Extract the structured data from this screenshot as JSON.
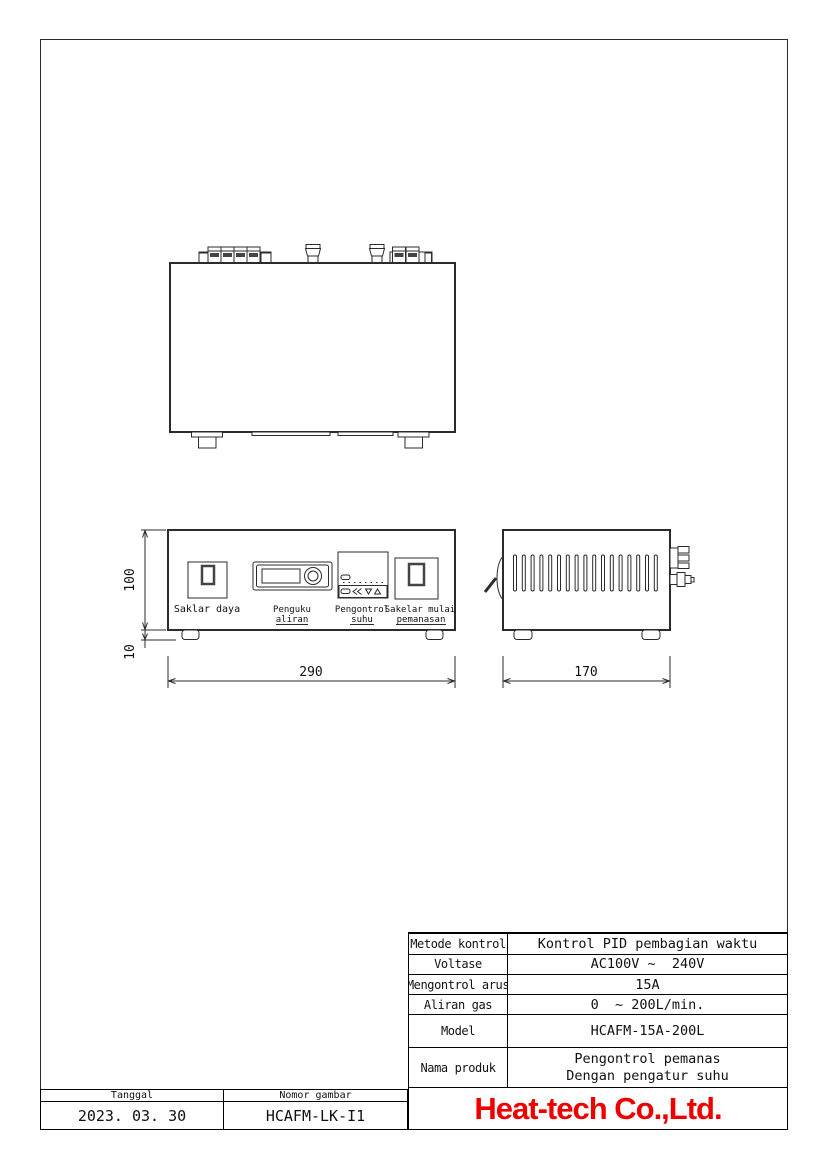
{
  "drawing": {
    "line_color": "#2b2b2b",
    "front_labels": {
      "power_switch": "Saklar daya",
      "flow_meter": [
        "Penguku",
        "aliran"
      ],
      "temp_controller": [
        "Pengontrol",
        "suhu"
      ],
      "start_switch": [
        "Sakelar mulai",
        "pemanasan"
      ]
    },
    "dimensions": {
      "height": "100",
      "feet_height": "10",
      "width": "290",
      "depth": "170"
    }
  },
  "spec_table": {
    "rows": [
      {
        "label": "Metode kontrol",
        "value": "Kontrol PID pembagian waktu"
      },
      {
        "label": "Voltase",
        "value": "AC100V ~  240V"
      },
      {
        "label": "Mengontrol arus",
        "value": "15A"
      },
      {
        "label": "Aliran gas",
        "value": "0  ~ 200L/min."
      },
      {
        "label": "Model",
        "value": "HCAFM-15A-200L"
      },
      {
        "label": "Nama produk",
        "value_line1": "Pengontrol pemanas",
        "value_line2": "Dengan pengatur suhu"
      }
    ],
    "company": "Heat-tech Co.,Ltd.",
    "company_color": "#ee0000"
  },
  "title_block": {
    "date_label": "Tanggal",
    "date_value": "2023. 03. 30",
    "drawing_number_label": "Nomor gambar",
    "drawing_number_value": "HCAFM-LK-I1"
  }
}
